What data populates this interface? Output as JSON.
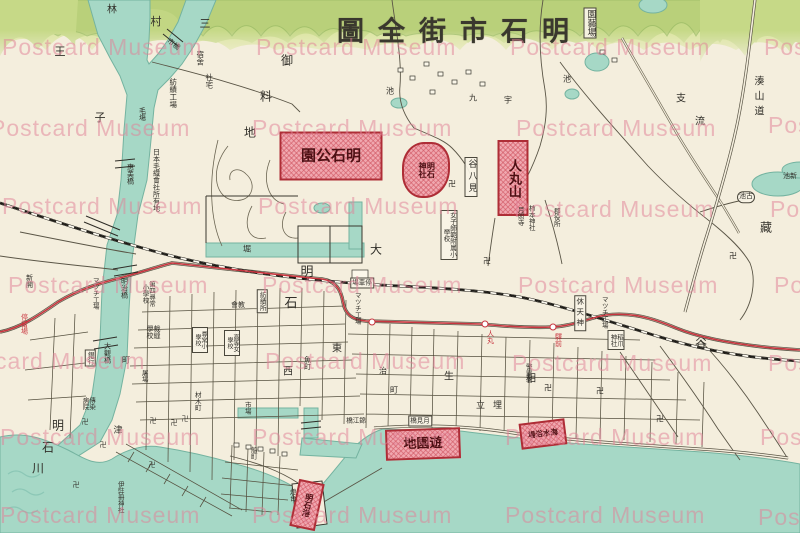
{
  "postcard": {
    "title": "明石市街全圖",
    "watermark_text": "Postcard Museum"
  },
  "colors": {
    "paper": "#f4eedd",
    "water": "#a6d8c6",
    "water_edge": "#74b3a0",
    "hill_back": "#dbe5a0",
    "hill_mid": "#c6d987",
    "hill_front": "#9dbd67",
    "road_ink": "#55503f",
    "rail_ink": "#1d1b16",
    "tram_red": "#c8353f",
    "site_border": "#ae2d36",
    "site_fill": "#f0a7af",
    "label_ink": "#32302a",
    "watermark_pink": "rgba(224,131,152,0.52)"
  },
  "red_sites": [
    {
      "t": "明石公園",
      "cx": 331,
      "cy": 156,
      "w": 99,
      "h": 45,
      "s": 15,
      "dir": "rtl"
    },
    {
      "t": "明石神社",
      "cx": 426,
      "cy": 170,
      "w": 44,
      "h": 52,
      "s": 8,
      "dir": "v",
      "th": 22,
      "rad": "46% 38% 52% 42%"
    },
    {
      "t": "人丸山",
      "cx": 513,
      "cy": 178,
      "w": 27,
      "h": 72,
      "s": 13,
      "dir": "v"
    },
    {
      "t": "遊園地",
      "cx": 423,
      "cy": 444,
      "w": 71,
      "h": 27,
      "s": 13,
      "dir": "rtl",
      "rot": -2
    },
    {
      "t": "明石港",
      "cx": 307,
      "cy": 505,
      "w": 22,
      "h": 44,
      "s": 8,
      "dir": "v",
      "rot": 12
    },
    {
      "t": "海水浴場",
      "cx": 543,
      "cy": 434,
      "w": 42,
      "h": 22,
      "s": 7.5,
      "dir": "rtl",
      "rot": -7
    }
  ],
  "tram": {
    "stops": [
      {
        "x": 372,
        "y": 322
      },
      {
        "x": 485,
        "y": 324
      },
      {
        "x": 553,
        "y": 327
      }
    ],
    "stop_labels": [
      {
        "t": "人丸",
        "x": 490,
        "y": 337
      },
      {
        "t": "驛前",
        "x": 558,
        "y": 340
      },
      {
        "t": "停留場",
        "x": 24,
        "y": 324
      }
    ]
  },
  "labels": [
    {
      "t": "明石市街全圖",
      "x": 460,
      "y": 32,
      "s": 27,
      "r": true,
      "ls": 14,
      "bold": true,
      "name": "map-title",
      "cls": "title"
    },
    {
      "t": "園藝場",
      "x": 590,
      "y": 23,
      "s": 9,
      "v": true,
      "b": true,
      "name": "engeijo-box"
    },
    {
      "t": "林",
      "x": 112,
      "y": 11,
      "s": 10
    },
    {
      "t": "村",
      "x": 156,
      "y": 22,
      "s": 11
    },
    {
      "t": "三",
      "x": 205,
      "y": 24,
      "s": 11
    },
    {
      "t": "市橋",
      "x": 173,
      "y": 45,
      "s": 7,
      "rot": 38
    },
    {
      "t": "宿舍",
      "x": 200,
      "y": 58,
      "s": 7.5,
      "v": true
    },
    {
      "t": "社宅",
      "x": 209,
      "y": 81,
      "s": 7.5,
      "v": true
    },
    {
      "t": "紡績工場",
      "x": 173,
      "y": 93,
      "s": 7.5,
      "v": true
    },
    {
      "t": "毛塲",
      "x": 142,
      "y": 114,
      "s": 7,
      "v": true
    },
    {
      "t": "王",
      "x": 60,
      "y": 52,
      "s": 11
    },
    {
      "t": "子",
      "x": 100,
      "y": 118,
      "s": 11
    },
    {
      "t": "御",
      "x": 287,
      "y": 61,
      "s": 12
    },
    {
      "t": "料",
      "x": 266,
      "y": 97,
      "s": 12
    },
    {
      "t": "地",
      "x": 250,
      "y": 133,
      "s": 12
    },
    {
      "t": "九",
      "x": 473,
      "y": 99,
      "s": 8
    },
    {
      "t": "宇",
      "x": 508,
      "y": 101,
      "s": 8
    },
    {
      "t": "池",
      "x": 390,
      "y": 92,
      "s": 8
    },
    {
      "t": "池",
      "x": 567,
      "y": 80,
      "s": 8
    },
    {
      "t": "湊山道",
      "x": 757,
      "y": 98,
      "s": 10,
      "v": true,
      "ls": 5
    },
    {
      "t": "支",
      "x": 681,
      "y": 100,
      "s": 10
    },
    {
      "t": "流",
      "x": 700,
      "y": 123,
      "s": 10
    },
    {
      "t": "藏",
      "x": 766,
      "y": 228,
      "s": 12
    },
    {
      "t": "谷",
      "x": 701,
      "y": 344,
      "s": 12
    },
    {
      "t": "古池",
      "x": 746,
      "y": 197,
      "s": 7,
      "r": true,
      "b": true,
      "cls": "pill"
    },
    {
      "t": "新池",
      "x": 790,
      "y": 177,
      "s": 7,
      "r": true
    },
    {
      "t": "惠美橋",
      "x": 130,
      "y": 174,
      "s": 7,
      "v": true
    },
    {
      "t": "日本毛織會社所有地",
      "x": 156,
      "y": 180,
      "s": 7,
      "v": true
    },
    {
      "t": "堀",
      "x": 247,
      "y": 250,
      "s": 8
    },
    {
      "t": "大",
      "x": 376,
      "y": 250,
      "s": 12
    },
    {
      "t": "谷八見",
      "x": 471,
      "y": 177,
      "s": 9,
      "v": true,
      "b": true,
      "ls": 3
    },
    {
      "t": "月照寺",
      "x": 520,
      "y": 216,
      "s": 6.5,
      "v": true
    },
    {
      "t": "柿本神社",
      "x": 531,
      "y": 218,
      "s": 6.5,
      "v": true
    },
    {
      "t": "郡役所",
      "x": 556,
      "y": 217,
      "s": 6.5,
      "v": true
    },
    {
      "t": "女子師範附属小學校",
      "x": 449,
      "y": 235,
      "s": 6.5,
      "v": true,
      "b": true,
      "h": 46
    },
    {
      "t": "卍",
      "x": 452,
      "y": 185,
      "s": 8
    },
    {
      "t": "卍",
      "x": 487,
      "y": 262,
      "s": 8
    },
    {
      "t": "卍",
      "x": 733,
      "y": 257,
      "s": 8
    },
    {
      "t": "卍",
      "x": 548,
      "y": 389,
      "s": 8
    },
    {
      "t": "卍",
      "x": 600,
      "y": 392,
      "s": 8
    },
    {
      "t": "卍",
      "x": 660,
      "y": 420,
      "s": 8
    },
    {
      "t": "卍",
      "x": 85,
      "y": 423,
      "s": 7
    },
    {
      "t": "卍",
      "x": 103,
      "y": 446,
      "s": 7
    },
    {
      "t": "卍",
      "x": 153,
      "y": 422,
      "s": 7
    },
    {
      "t": "卍",
      "x": 174,
      "y": 424,
      "s": 7
    },
    {
      "t": "卍",
      "x": 185,
      "y": 420,
      "s": 7
    },
    {
      "t": "卍",
      "x": 152,
      "y": 466,
      "s": 7
    },
    {
      "t": "卍",
      "x": 76,
      "y": 486,
      "s": 7
    },
    {
      "t": "明",
      "x": 307,
      "y": 273,
      "s": 13
    },
    {
      "t": "石",
      "x": 291,
      "y": 304,
      "s": 13
    },
    {
      "t": "停車場",
      "x": 362,
      "y": 283,
      "s": 6.5,
      "r": true,
      "b": true
    },
    {
      "t": "明治橋",
      "x": 124,
      "y": 288,
      "s": 7,
      "v": true
    },
    {
      "t": "大觀橋",
      "x": 107,
      "y": 353,
      "s": 7,
      "v": true
    },
    {
      "t": "第四尋常小學校",
      "x": 148,
      "y": 294,
      "s": 6.5,
      "v": true,
      "h": 30
    },
    {
      "t": "マツチ工場",
      "x": 95,
      "y": 293,
      "s": 6.5,
      "v": true
    },
    {
      "t": "マツチ工場",
      "x": 357,
      "y": 308,
      "s": 6.5,
      "v": true
    },
    {
      "t": "マツチ工場",
      "x": 604,
      "y": 312,
      "s": 6.5,
      "v": true
    },
    {
      "t": "教會",
      "x": 238,
      "y": 306,
      "s": 7,
      "r": true
    },
    {
      "t": "紡績所",
      "x": 262,
      "y": 301,
      "s": 6.5,
      "v": true,
      "b": true
    },
    {
      "t": "裁縫學校",
      "x": 153,
      "y": 332,
      "s": 7,
      "v": true,
      "h": 16
    },
    {
      "t": "尋常小學校",
      "x": 200,
      "y": 340,
      "s": 6,
      "v": true,
      "b": true,
      "h": 22
    },
    {
      "t": "高等女學校",
      "x": 232,
      "y": 343,
      "s": 6,
      "v": true,
      "b": true,
      "h": 22
    },
    {
      "t": "銀行",
      "x": 90,
      "y": 358,
      "s": 6.5,
      "v": true,
      "b": true
    },
    {
      "t": "町",
      "x": 126,
      "y": 361,
      "s": 8
    },
    {
      "t": "東",
      "x": 337,
      "y": 350,
      "s": 10
    },
    {
      "t": "西",
      "x": 288,
      "y": 373,
      "s": 10
    },
    {
      "t": "魚町",
      "x": 307,
      "y": 363,
      "s": 7,
      "v": true
    },
    {
      "t": "治",
      "x": 383,
      "y": 372,
      "s": 8
    },
    {
      "t": "町",
      "x": 394,
      "y": 391,
      "s": 8
    },
    {
      "t": "生",
      "x": 449,
      "y": 378,
      "s": 10
    },
    {
      "t": "相",
      "x": 531,
      "y": 380,
      "s": 10
    },
    {
      "t": "休天神",
      "x": 580,
      "y": 313,
      "s": 7.5,
      "v": true,
      "b": true,
      "ls": 3
    },
    {
      "t": "稻爪神社",
      "x": 616,
      "y": 340,
      "s": 6.5,
      "v": true,
      "b": true,
      "h": 16
    },
    {
      "t": "警察署",
      "x": 528,
      "y": 373,
      "s": 6.5,
      "v": true
    },
    {
      "t": "埋立",
      "x": 493,
      "y": 407,
      "s": 9,
      "r": true,
      "ls": 8
    },
    {
      "t": "傳染病院",
      "x": 88,
      "y": 403,
      "s": 6.5,
      "v": true,
      "h": 16
    },
    {
      "t": "屠場",
      "x": 144,
      "y": 376,
      "s": 6.5,
      "v": true
    },
    {
      "t": "津",
      "x": 118,
      "y": 432,
      "s": 9
    },
    {
      "t": "材木町",
      "x": 197,
      "y": 401,
      "s": 6.5,
      "v": true
    },
    {
      "t": "伊弉冊神社",
      "x": 120,
      "y": 497,
      "s": 6.5,
      "v": true
    },
    {
      "t": "燈台",
      "x": 292,
      "y": 495,
      "s": 6.5,
      "v": true
    },
    {
      "t": "船町",
      "x": 253,
      "y": 453,
      "s": 6.5,
      "v": true
    },
    {
      "t": "市場",
      "x": 247,
      "y": 408,
      "s": 6.5,
      "v": true
    },
    {
      "t": "錦江橋",
      "x": 356,
      "y": 421,
      "s": 6.5,
      "r": true
    },
    {
      "t": "月見橋",
      "x": 420,
      "y": 421,
      "s": 6.5,
      "r": true,
      "b": true
    },
    {
      "t": "明",
      "x": 58,
      "y": 426,
      "s": 12
    },
    {
      "t": "石",
      "x": 48,
      "y": 448,
      "s": 12
    },
    {
      "t": "川",
      "x": 38,
      "y": 469,
      "s": 12
    },
    {
      "t": "新開",
      "x": 29,
      "y": 281,
      "s": 7,
      "v": true
    }
  ],
  "watermarks": [
    {
      "x": 2,
      "y": 34
    },
    {
      "x": 256,
      "y": 34
    },
    {
      "x": 510,
      "y": 34
    },
    {
      "x": 764,
      "y": 34
    },
    {
      "x": -10,
      "y": 115
    },
    {
      "x": 252,
      "y": 115
    },
    {
      "x": 516,
      "y": 115
    },
    {
      "x": 768,
      "y": 112
    },
    {
      "x": 2,
      "y": 193
    },
    {
      "x": 258,
      "y": 193
    },
    {
      "x": 514,
      "y": 196
    },
    {
      "x": 770,
      "y": 196
    },
    {
      "x": 8,
      "y": 272
    },
    {
      "x": 262,
      "y": 272
    },
    {
      "x": 518,
      "y": 272
    },
    {
      "x": 774,
      "y": 272
    },
    {
      "x": -55,
      "y": 348
    },
    {
      "x": 265,
      "y": 348
    },
    {
      "x": 512,
      "y": 350
    },
    {
      "x": 768,
      "y": 350
    },
    {
      "x": 0,
      "y": 424
    },
    {
      "x": 252,
      "y": 424
    },
    {
      "x": 505,
      "y": 424
    },
    {
      "x": 760,
      "y": 424
    },
    {
      "x": 0,
      "y": 502
    },
    {
      "x": 252,
      "y": 502
    },
    {
      "x": 505,
      "y": 502
    },
    {
      "x": 758,
      "y": 504
    }
  ]
}
